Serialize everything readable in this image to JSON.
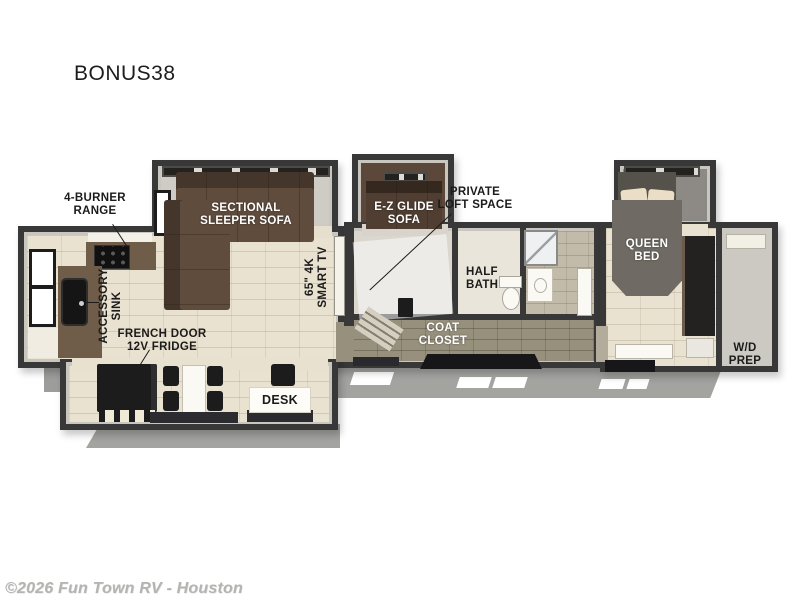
{
  "page": {
    "title": "BONUS38",
    "watermark": "©2026 Fun Town RV - Houston",
    "background": "#ffffff"
  },
  "floorplan": {
    "model": "BONUS38",
    "labels": {
      "range": [
        "4-BURNER",
        "RANGE"
      ],
      "sectional_sofa": [
        "SECTIONAL",
        "SLEEPER SOFA"
      ],
      "ez_glide_sofa": [
        "E-Z GLIDE",
        "SOFA"
      ],
      "private_loft": [
        "PRIVATE",
        "LOFT SPACE"
      ],
      "half_bath": [
        "HALF",
        "BATH"
      ],
      "smart_tv": [
        "65\" 4K",
        "SMART TV"
      ],
      "accessory_sink": [
        "ACCESSORY",
        "SINK"
      ],
      "fridge": [
        "FRENCH DOOR",
        "12V FRIDGE"
      ],
      "coat_closet": [
        "COAT",
        "CLOSET"
      ],
      "desk": "DESK",
      "queen_bed": [
        "QUEEN",
        "BED"
      ],
      "wd_prep": [
        "W/D",
        "PREP"
      ]
    },
    "colors": {
      "wall": "#383838",
      "wall_inner": "#c9c6bf",
      "floor_cream": "#e9e2d0",
      "floor_hall": "#97907d",
      "sofa_brown": "#5f4c3d",
      "bed_gray": "#6f6b64",
      "fixture_black": "#1c1c1c",
      "counter_brown": "#6f5d49",
      "chassis_gray": "#a3a3a0",
      "label_dark": "#1b1b1b",
      "label_light": "#ffffff"
    }
  }
}
